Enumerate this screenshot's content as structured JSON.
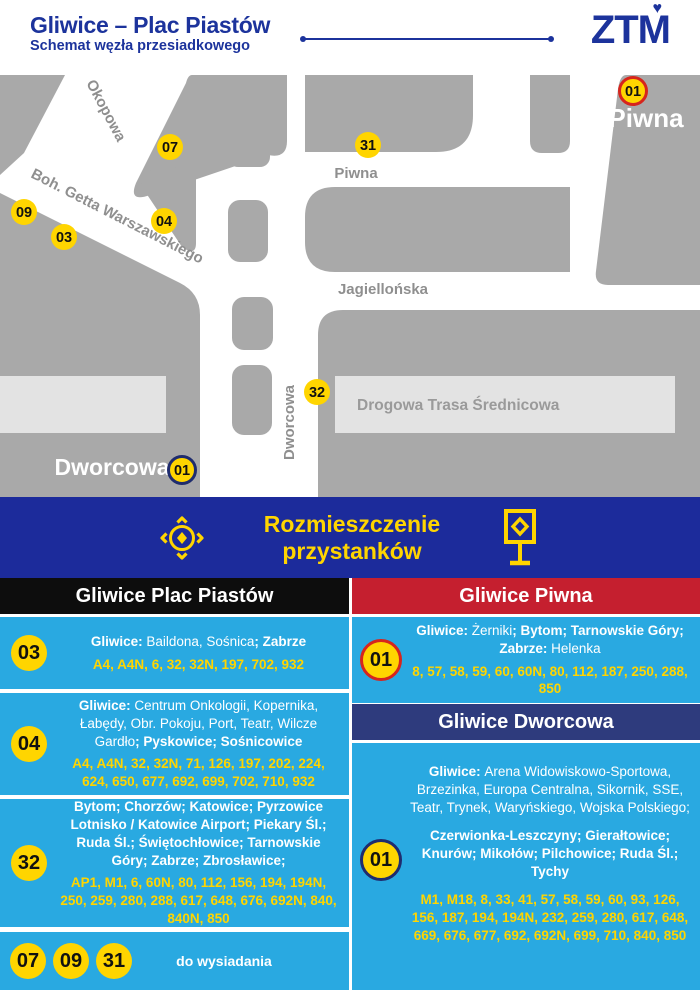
{
  "header": {
    "title": "Gliwice – Plac Piastów",
    "subtitle": "Schemat węzła przesiadkowego",
    "logo_text": "ZTM"
  },
  "map": {
    "streets": {
      "okopowa": "Okopowa",
      "getta": "Boh. Getta Warszawskiego",
      "piwna": "Piwna",
      "jagiellonska": "Jagiellońska",
      "dts": "Drogowa Trasa Średnicowa",
      "dworcowa": "Dworcowa"
    },
    "areas": {
      "piwna": "Piwna",
      "dworcowa": "Dworcowa"
    },
    "markers": {
      "m07": "07",
      "m31": "31",
      "m09": "09",
      "m03": "03",
      "m04": "04",
      "m32": "32",
      "m01_piwna": "01",
      "m01_dworcowa": "01"
    }
  },
  "banner": {
    "line1": "Rozmieszczenie",
    "line2": "przystanków"
  },
  "panels": {
    "left": {
      "header": "Gliwice Plac Piastów",
      "entries": [
        {
          "badge": "03",
          "destinations": [
            {
              "t": "Gliwice: ",
              "b": true
            },
            {
              "t": "Baildona, Sośnica",
              "b": false
            },
            {
              "t": "; Zabrze",
              "b": true
            }
          ],
          "lines": "A4, A4N, 6, 32, 32N, 197, 702, 932"
        },
        {
          "badge": "04",
          "destinations": [
            {
              "t": "Gliwice: ",
              "b": true
            },
            {
              "t": "Centrum Onkologii, Kopernika, Łabędy, Obr. Pokoju, Port, Teatr, Wilcze Gardło",
              "b": false
            },
            {
              "t": "; Pyskowice; Sośnicowice",
              "b": true
            }
          ],
          "lines": "A4, A4N, 32, 32N, 71, 126, 197, 202, 224, 624, 650, 677, 692, 699, 702, 710, 932"
        },
        {
          "badge": "32",
          "destinations": [
            {
              "t": "Bytom; Chorzów; Katowice; Pyrzowice Lotnisko / Katowice Airport; Piekary Śl.; Ruda Śl.; Świętochłowice; Tarnowskie Góry; Zabrze; Zbrosławice;",
              "b": true
            }
          ],
          "lines": "AP1, M1, 6, 60N, 80, 112, 156, 194, 194N, 250, 259, 280, 288, 617, 648, 676, 692N, 840, 840N, 850"
        }
      ],
      "exit": {
        "badges": [
          "07",
          "09",
          "31"
        ],
        "label": "do wysiadania"
      }
    },
    "right": {
      "piwna_header": "Gliwice Piwna",
      "piwna_entry": {
        "badge": "01",
        "destinations": [
          {
            "t": "Gliwice: ",
            "b": true
          },
          {
            "t": "Żerniki",
            "b": false
          },
          {
            "t": "; Bytom; Tarnowskie Góry; Zabrze: ",
            "b": true
          },
          {
            "t": "Helenka",
            "b": false
          }
        ],
        "lines": "8, 57, 58, 59, 60, 60N, 80, 112, 187, 250, 288, 850"
      },
      "dworcowa_header": "Gliwice Dworcowa",
      "dworcowa_entry": {
        "badge": "01",
        "destinations_1": [
          {
            "t": "Gliwice: ",
            "b": true
          },
          {
            "t": "Arena Widowiskowo-Sportowa, Brzezinka, Europa Centralna, Sikornik, SSE, Teatr, Trynek, Waryńskiego, Wojska Polskiego;",
            "b": false
          }
        ],
        "destinations_2": [
          {
            "t": "Czerwionka-Leszczyny; Gierałtowice; Knurów; Mikołów; Pilchowice; Ruda Śl.; Tychy",
            "b": true
          }
        ],
        "lines": "M1, M18, 8, 33, 41, 57, 58, 59, 60, 93, 126, 156, 187, 194, 194N, 232, 259, 280, 617, 648, 669, 676, 677, 692, 692N, 699, 710, 840, 850"
      }
    }
  },
  "colors": {
    "brand_blue": "#1c339c",
    "banner_blue": "#1c2b9b",
    "light_blue": "#29a9e1",
    "red": "#c51f2f",
    "navy_header": "#2e3b7d",
    "yellow": "#ffd500",
    "ring_red": "#d6251d",
    "ring_navy": "#1f2c6e",
    "map_gray": "#a9a9a9",
    "highway_gray": "#e3e3e3"
  }
}
